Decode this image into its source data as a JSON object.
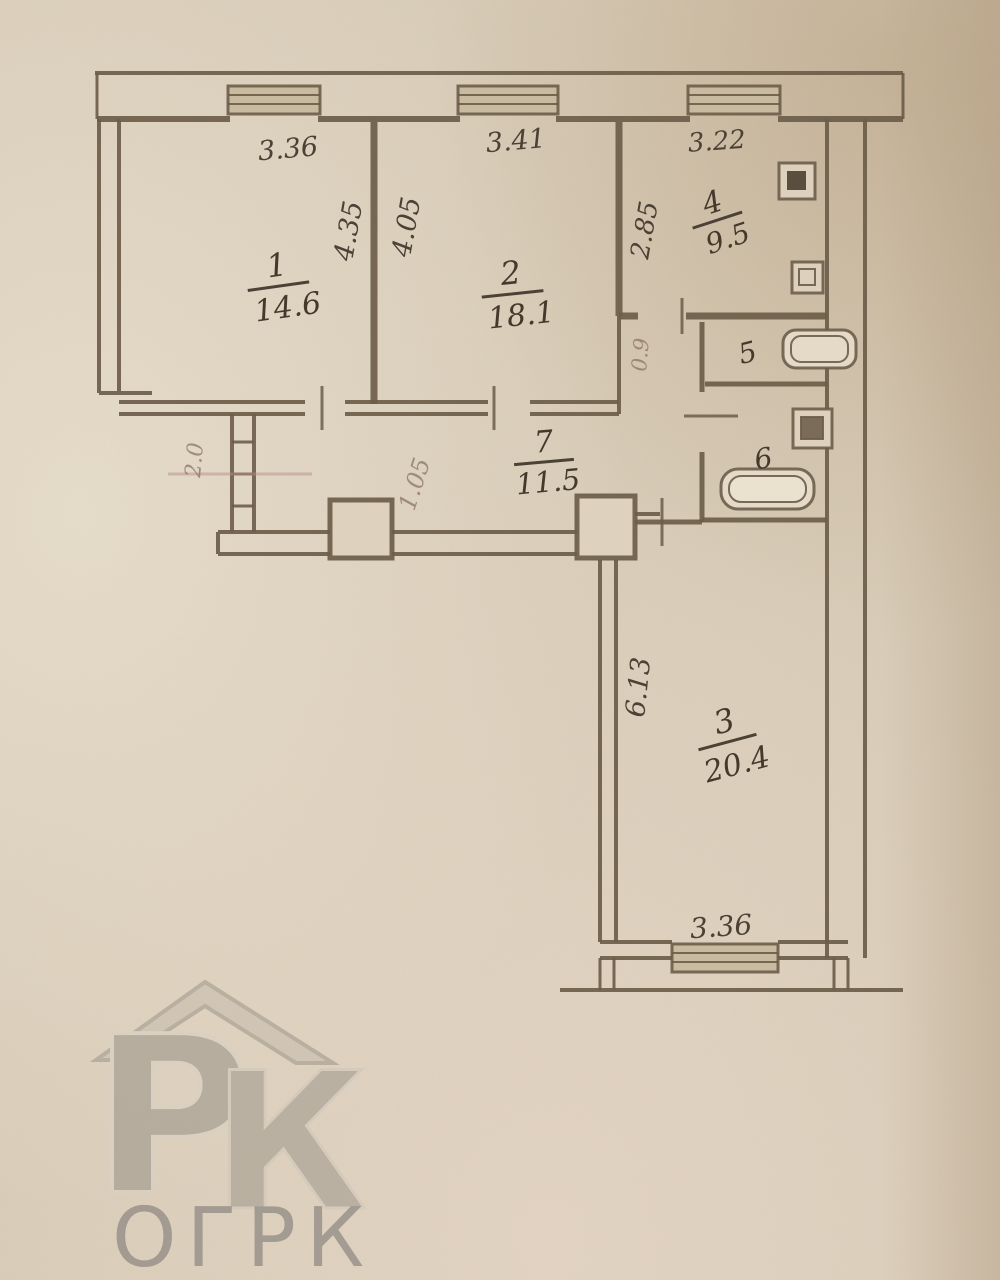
{
  "plan": {
    "rooms": [
      {
        "id": "room-1",
        "number": "1",
        "area": "14.6"
      },
      {
        "id": "room-2",
        "number": "2",
        "area": "18.1"
      },
      {
        "id": "room-3",
        "number": "3",
        "area": "20.4"
      },
      {
        "id": "room-4",
        "number": "4",
        "area": "9.5"
      },
      {
        "id": "room-5",
        "number": "5",
        "area": ""
      },
      {
        "id": "room-6",
        "number": "6",
        "area": ""
      },
      {
        "id": "room-7",
        "number": "7",
        "area": "11.5"
      }
    ],
    "dimensions": [
      {
        "value": "3.36",
        "location": "room-1-top"
      },
      {
        "value": "4.35",
        "location": "room-1-right-vertical"
      },
      {
        "value": "4.05",
        "location": "room-2-left-vertical"
      },
      {
        "value": "3.41",
        "location": "room-2-top"
      },
      {
        "value": "2.85",
        "location": "room-4-left-vertical"
      },
      {
        "value": "3.22",
        "location": "room-4-top"
      },
      {
        "value": "6.13",
        "location": "room-3-left-vertical"
      },
      {
        "value": "3.36",
        "location": "room-3-bottom"
      }
    ],
    "pencil_annotations": [
      {
        "value": "2.0"
      },
      {
        "value": "1.05"
      },
      {
        "value": "0.9"
      }
    ],
    "fixtures": [
      "stove",
      "kitchen-sink",
      "bathtub",
      "wash-basin",
      "bath"
    ]
  },
  "watermark": {
    "monogram_p": "Р",
    "monogram_k": "К",
    "brand": "ОГРК"
  },
  "colors": {
    "paper": "#d9cdb9",
    "ink": "#6b5d49",
    "handwriting": "#4c4136",
    "watermark_gray": "#9a9288"
  }
}
